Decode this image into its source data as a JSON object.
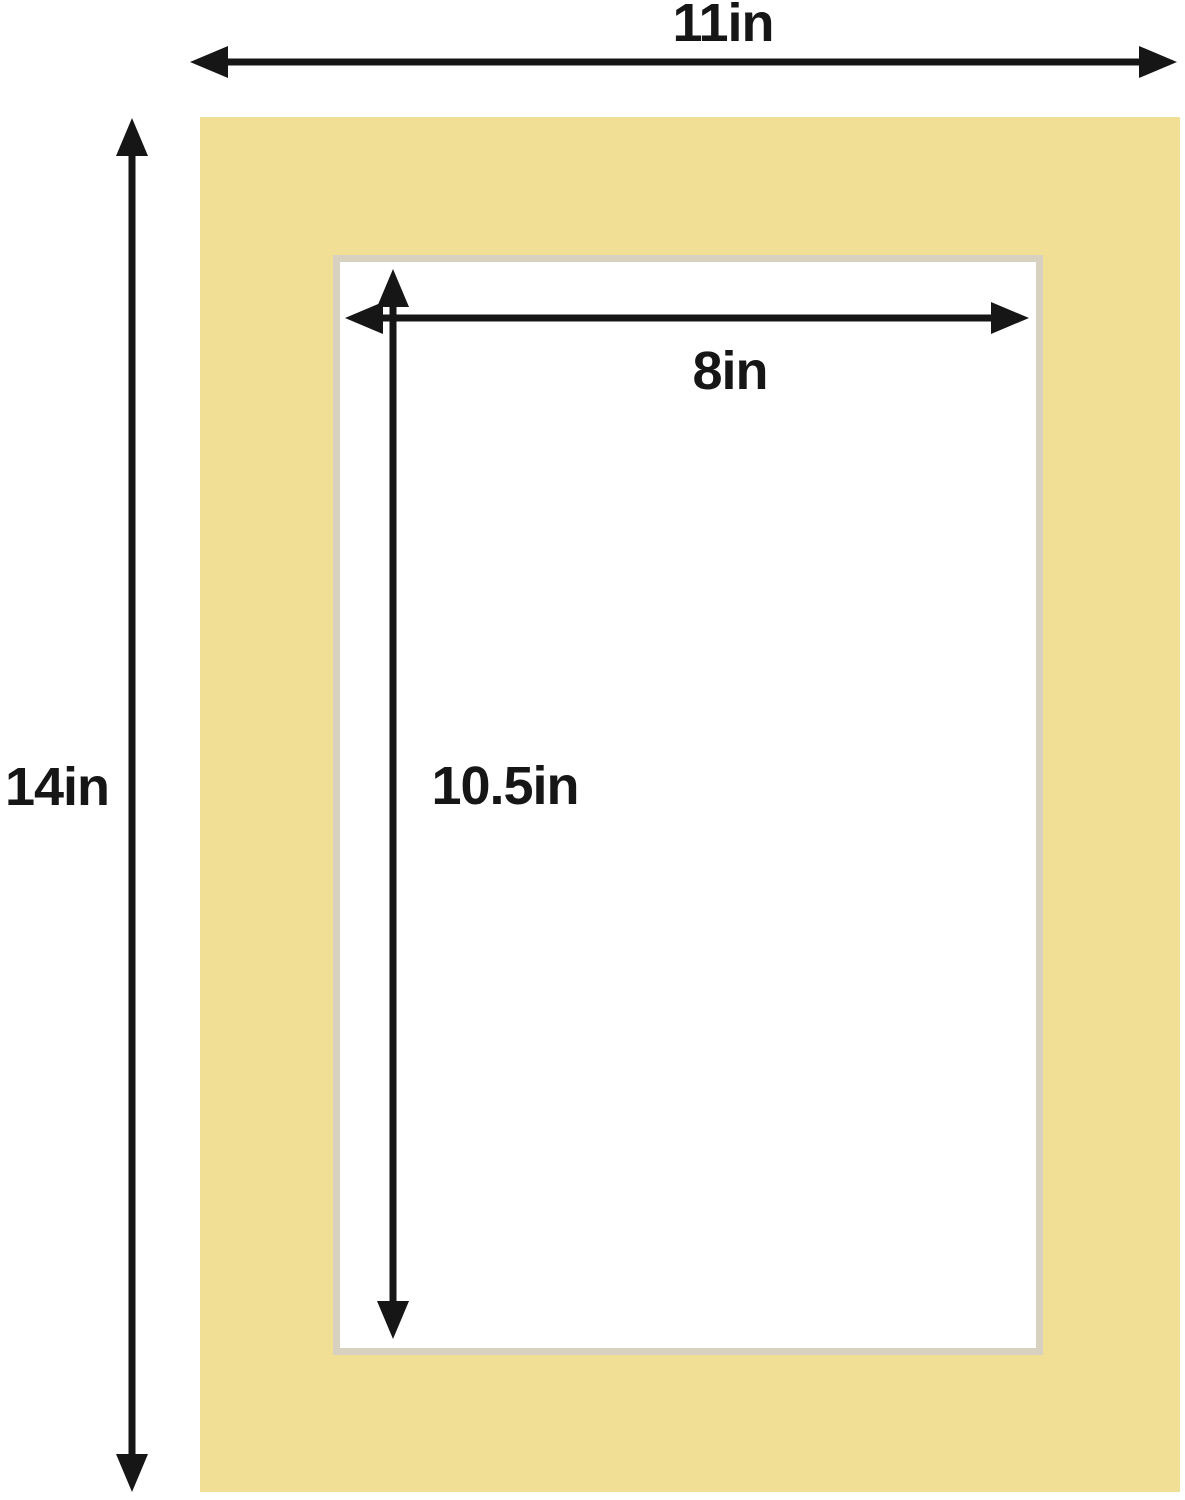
{
  "labels": {
    "outer_width": "11in",
    "outer_height": "14in",
    "opening_width": "8in",
    "opening_height": "10.5in"
  },
  "colors": {
    "mat": "#f2df96",
    "bevel": "#d8d1bf",
    "arrow": "#161616",
    "bg": "#ffffff"
  }
}
